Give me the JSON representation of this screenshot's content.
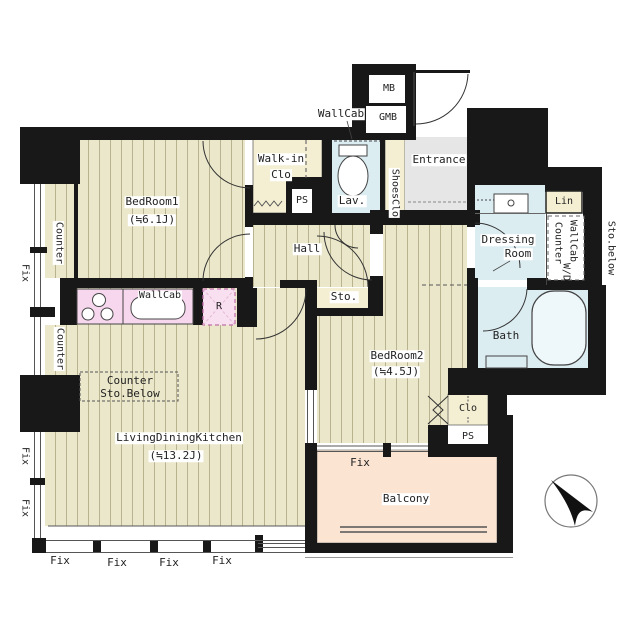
{
  "title": "apartment-floor-plan",
  "colors": {
    "wall": "#181818",
    "wood_floor": "#ebe7ca",
    "wood_line": "#b9b28e",
    "closet": "#f4efd3",
    "wet_area": "#dcedf2",
    "entrance_floor": "#e6e6e6",
    "kitchen_fixture": "#f7d7ee",
    "balcony": "#fce4d3"
  },
  "rooms": {
    "bedroom1": {
      "name": "BedRoom1",
      "size": "(≒6.1J)"
    },
    "bedroom2": {
      "name": "BedRoom2",
      "size": "(≒4.5J)"
    },
    "ldk": {
      "name": "LivingDiningKitchen",
      "size": "(≒13.2J)"
    },
    "hall": {
      "name": "Hall"
    },
    "sto": {
      "name": "Sto."
    },
    "walk_in_clo": {
      "line1": "Walk-in",
      "line2": "Clo"
    },
    "lav": {
      "name": "Lav."
    },
    "entrance": {
      "name": "Entrance"
    },
    "shoes_clo": {
      "name": "ShoesClo"
    },
    "dressing_room": {
      "line1": "Dressing",
      "line2": "Room"
    },
    "bath": {
      "name": "Bath"
    },
    "balcony": {
      "name": "Balcony"
    },
    "clo": {
      "name": "Clo"
    },
    "lin": {
      "name": "Lin"
    }
  },
  "fixtures": {
    "kitchen_wall_cabinet": "WallCab",
    "lav_wall_cabinet": "WallCab",
    "refrigerator": "R",
    "meter_box": "MB",
    "gas_meter_box": "GMB",
    "pipe_space_upper": "PS",
    "pipe_space_lower": "PS",
    "counter_storage_below": {
      "line1": "Counter",
      "line2": "Sto.Below"
    },
    "wd_area": {
      "line1": "WallCab",
      "line2": "Counter",
      "line3": "W/D"
    },
    "storage_below_window": "Sto.below",
    "counter_upper": "Counter",
    "counter_lower": "Counter"
  },
  "windows": {
    "fix_left_top": "Fix",
    "fix_left_mid": "Fix",
    "fix_left_bottom": "Fix",
    "fix_bottom_1": "Fix",
    "fix_bottom_2": "Fix",
    "fix_bottom_3": "Fix",
    "fix_bottom_4": "Fix",
    "fix_bedroom2": "Fix"
  }
}
